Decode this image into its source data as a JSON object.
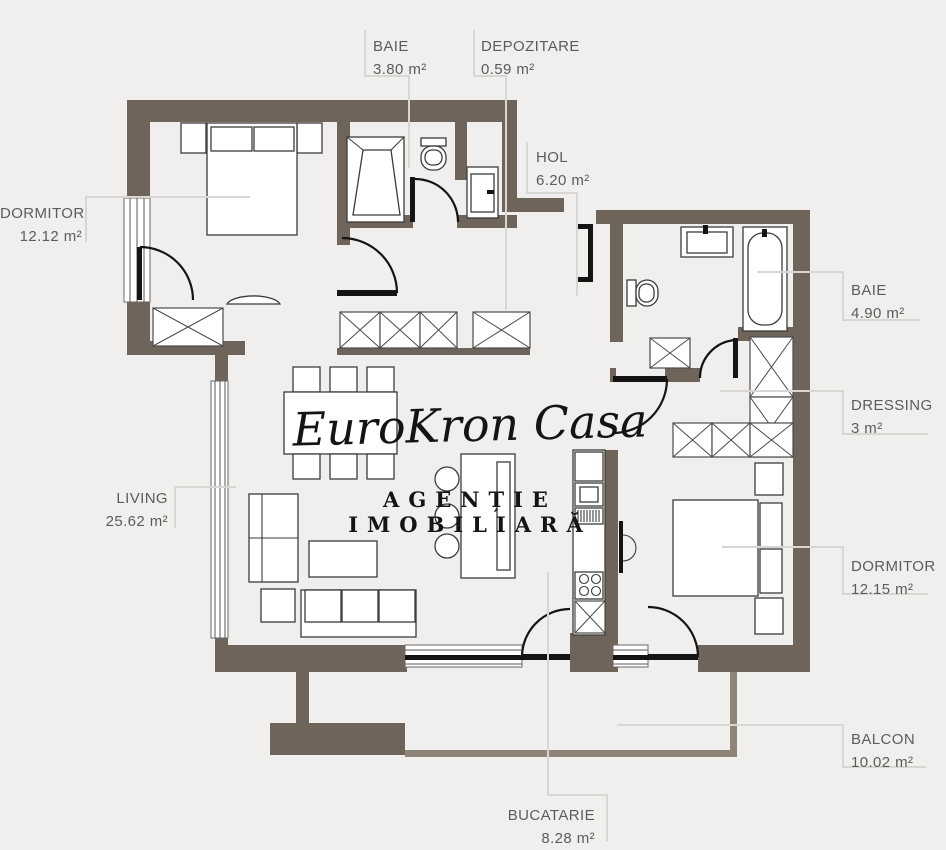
{
  "watermark": {
    "script": "EuroKron Casa",
    "subtitle": "AGENȚIE IMOBILIARĂ"
  },
  "rooms": [
    {
      "id": "baie-top",
      "name": "BAIE",
      "area": "3.80 m²"
    },
    {
      "id": "depozitare",
      "name": "DEPOZITARE",
      "area": "0.59 m²"
    },
    {
      "id": "hol",
      "name": "HOL",
      "area": "6.20 m²"
    },
    {
      "id": "dormitor-stanga",
      "name": "DORMITOR",
      "area": "12.12 m²"
    },
    {
      "id": "living",
      "name": "LIVING",
      "area": "25.62 m²"
    },
    {
      "id": "baie-dreapta",
      "name": "BAIE",
      "area": "4.90 m²"
    },
    {
      "id": "dressing",
      "name": "DRESSING",
      "area": "3 m²"
    },
    {
      "id": "dormitor-dreapta",
      "name": "DORMITOR",
      "area": "12.15 m²"
    },
    {
      "id": "balcon",
      "name": "BALCON",
      "area": "10.02 m²"
    },
    {
      "id": "bucatarie",
      "name": "BUCATARIE",
      "area": "8.28 m²"
    }
  ],
  "colors": {
    "background": "#f0efed",
    "wall": "#6f6459",
    "parapet": "#8d8478",
    "leader": "#d9d5d0",
    "label_text": "#5c5c5c",
    "watermark_text": "#141414"
  }
}
